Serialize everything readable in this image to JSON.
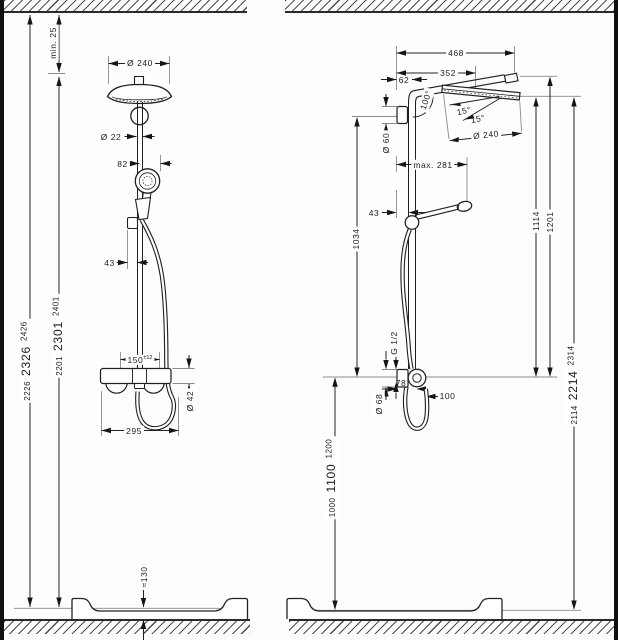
{
  "left": {
    "min_clearance": "min. 25",
    "head_diameter": "Ø 240",
    "pipe_diameter": "Ø 22",
    "hand_shower_offset": "82",
    "holder_offset": "43",
    "connection_center": "150",
    "connection_tolerance": "±12",
    "valve_diameter": "Ø 42",
    "valve_width": "295",
    "tray_height": "≈130",
    "height_to_tray": {
      "low": "2226",
      "mid": "2326",
      "high": "2426"
    },
    "height_pipe_top": {
      "low": "2201",
      "mid": "2301",
      "high": "2401"
    }
  },
  "right": {
    "reach_total": "468",
    "reach_center": "352",
    "wall_to_pipe": "62",
    "arm_angle": "100°",
    "head_tilt_a": "15°",
    "head_tilt_b": "15°",
    "head_diameter": "Ø 240",
    "bracket_diameter": "Ø 60",
    "max_extension": "max. 281",
    "holder_offset": "43",
    "bar_length": "1034",
    "height_head_face": "1114",
    "height_arm": "1201",
    "thread": "G 1/2",
    "escutcheon_diameter": "Ø 68",
    "depth": "78",
    "hose_clearance": "100",
    "height_connection": {
      "low": "1000",
      "mid": "1100",
      "high": "1200"
    },
    "height_total": {
      "low": "2114",
      "mid": "2214",
      "high": "2314"
    }
  }
}
